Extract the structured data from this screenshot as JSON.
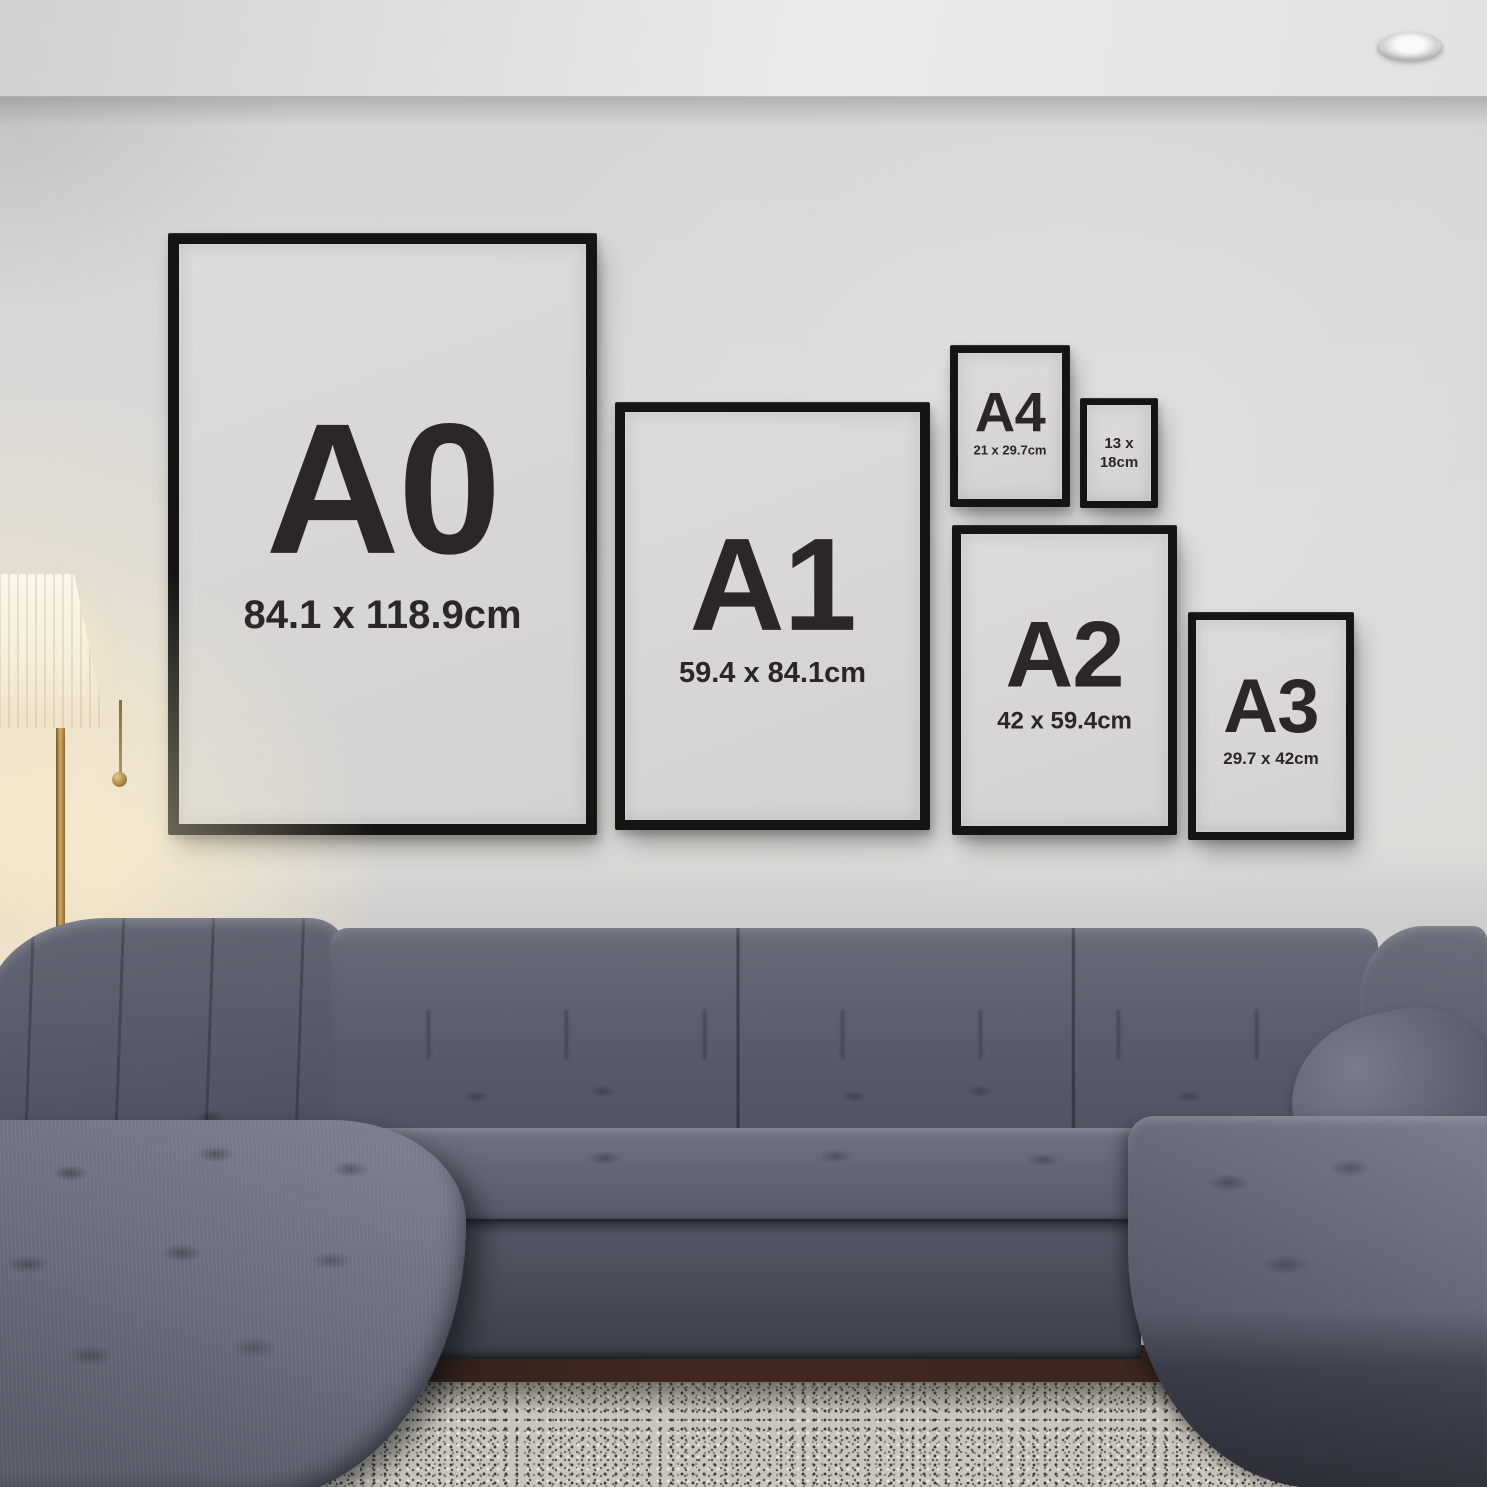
{
  "frames": [
    {
      "name": "A0",
      "label": "A0",
      "size": "84.1 x 118.9cm"
    },
    {
      "name": "A1",
      "label": "A1",
      "size": "59.4 x 84.1cm"
    },
    {
      "name": "A4",
      "label": "A4",
      "size": "21 x 29.7cm"
    },
    {
      "name": "13x18",
      "label": "13 x",
      "size": "18cm"
    },
    {
      "name": "A2",
      "label": "A2",
      "size": "42 x 59.4cm"
    },
    {
      "name": "A3",
      "label": "A3",
      "size": "29.7 x 42cm"
    }
  ],
  "colors": {
    "frame-border": "#141414",
    "frame-mat": "#d3d2d0",
    "frame-text": "#2b2728",
    "wall-base": "#dad9d7",
    "sofa-mid": "#626674",
    "sofa-dark": "#434754",
    "sofa-light": "#7d8190",
    "rug-base": "#c9c5bd",
    "floor-wood": "#42291f",
    "lamp-shade": "#fdf7ea"
  }
}
